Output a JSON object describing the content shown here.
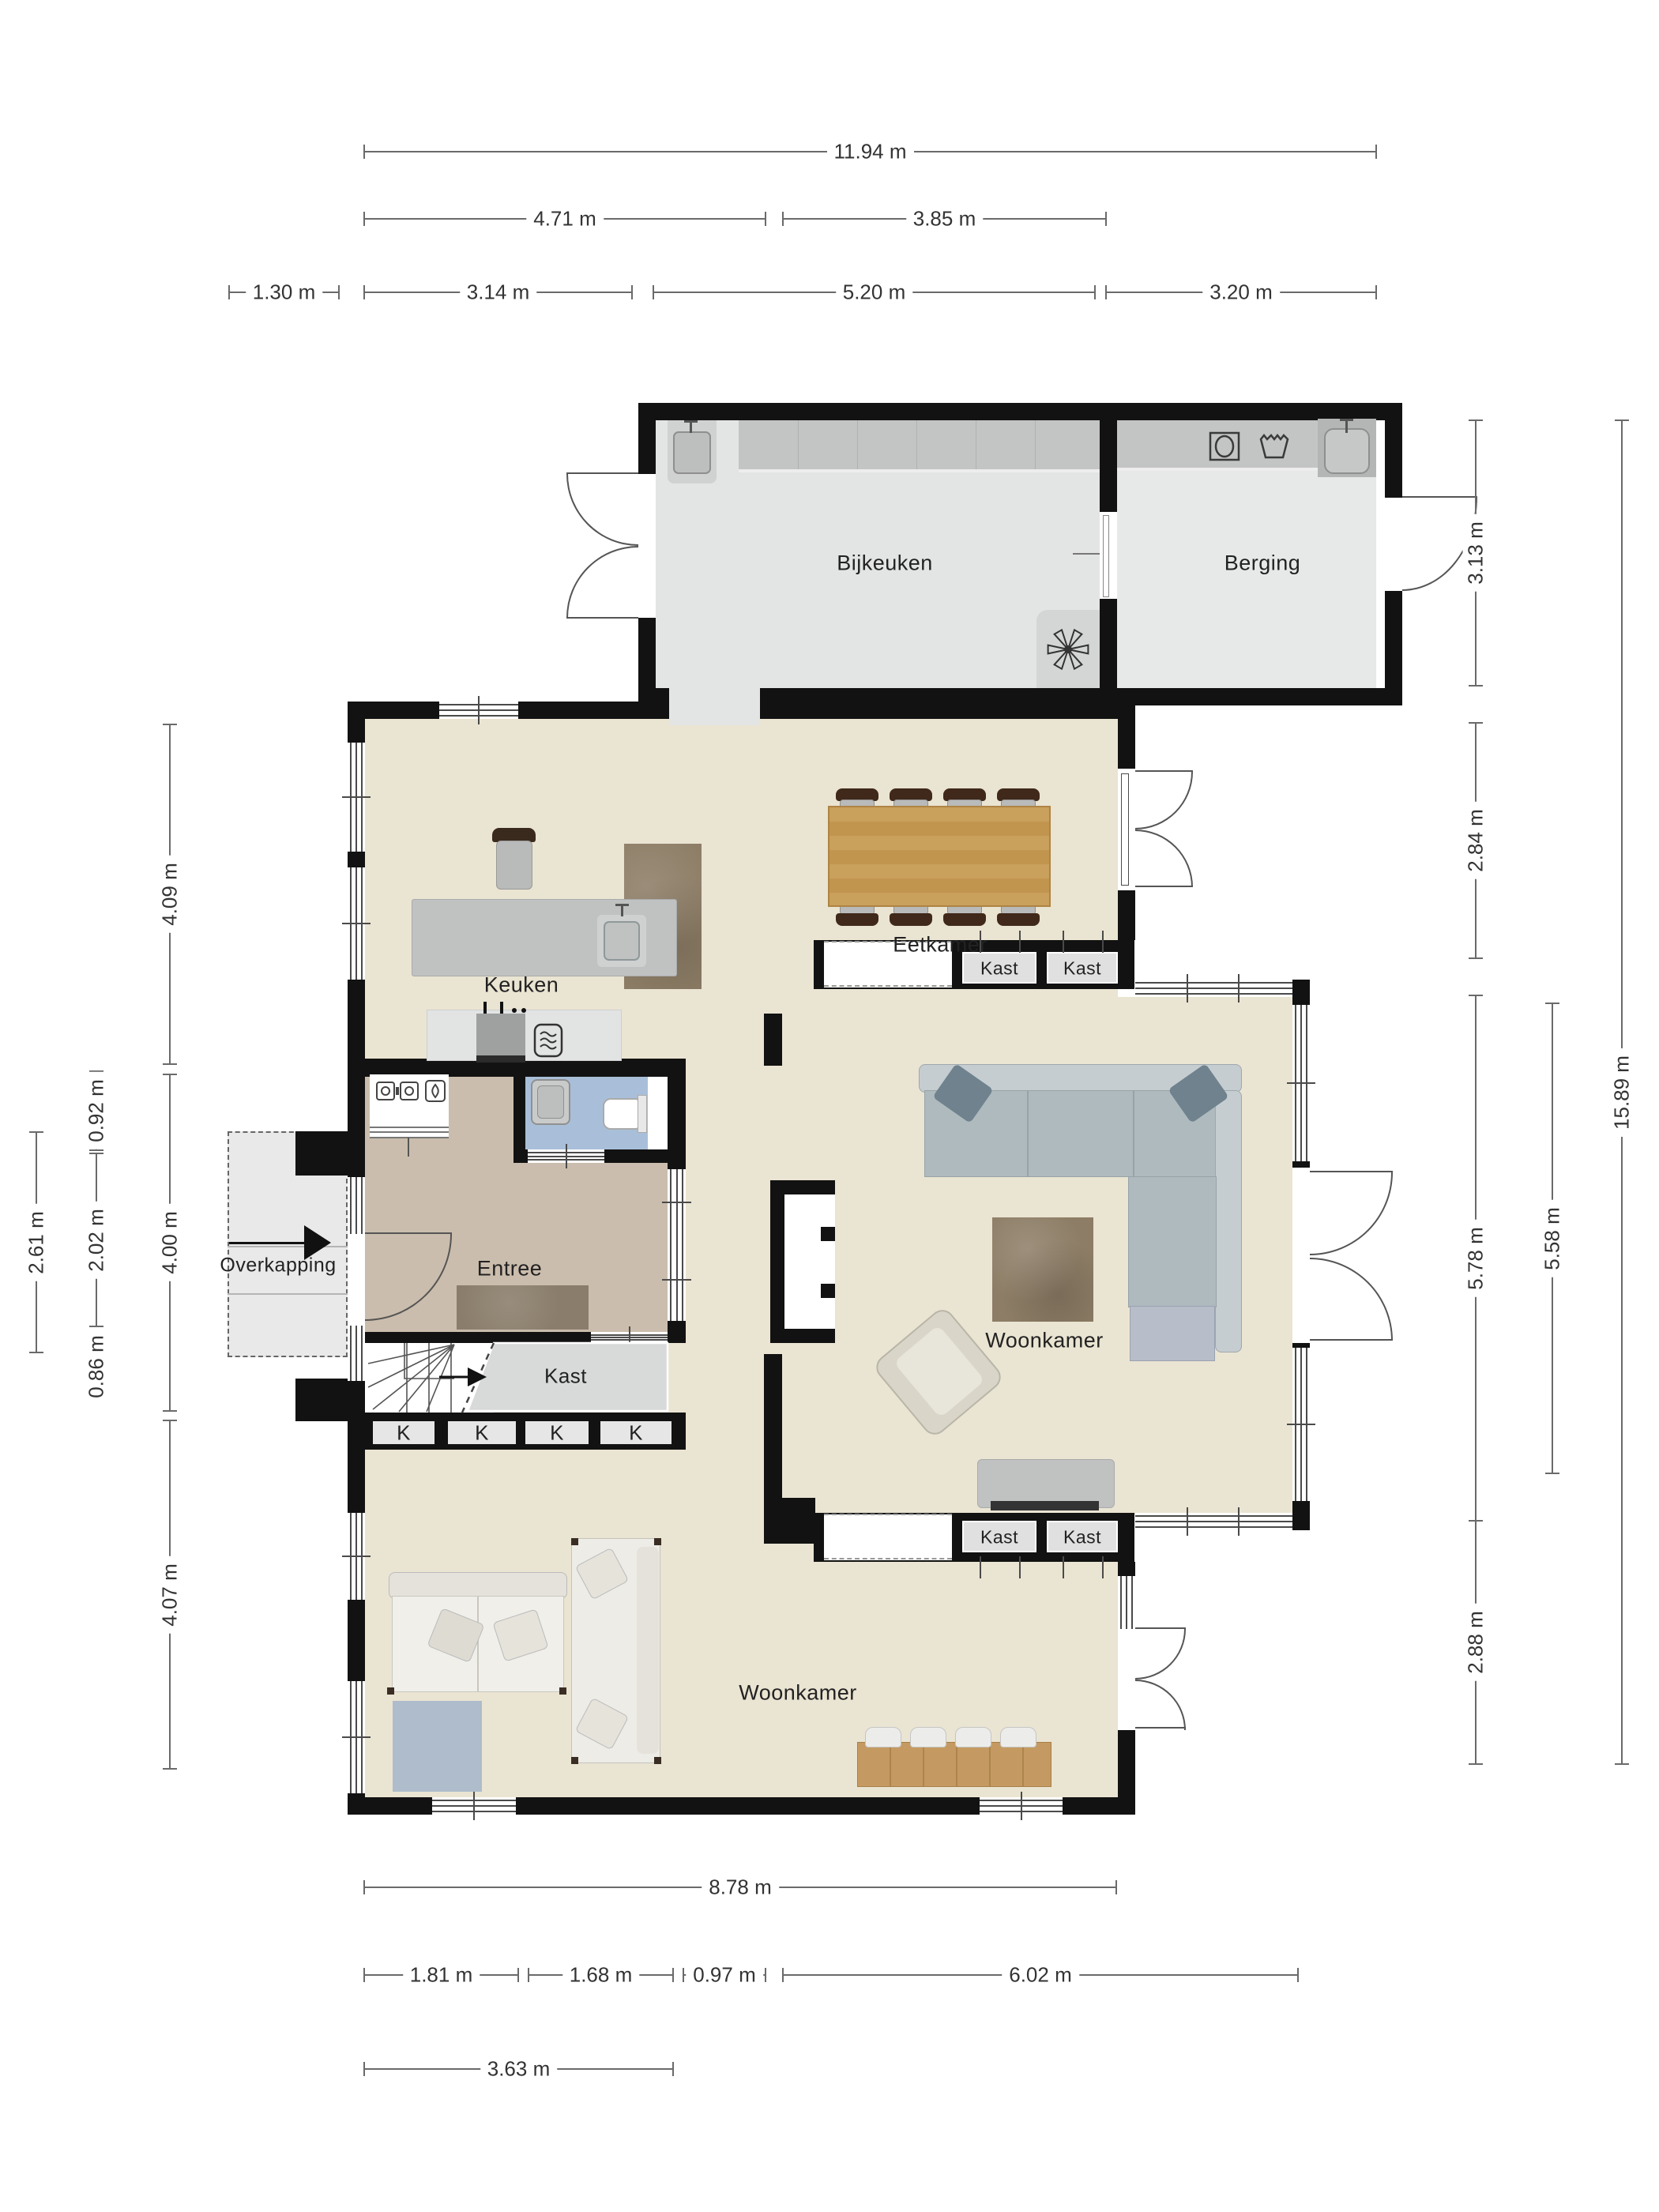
{
  "rooms": {
    "bijkeuken": "Bijkeuken",
    "berging": "Berging",
    "keuken": "Keuken",
    "eetkamer": "Eetkamer",
    "woonkamer_upper": "Woonkamer",
    "woonkamer_lower": "Woonkamer",
    "entree": "Entree",
    "overkapping": "Overkapping",
    "kast_stairs": "Kast"
  },
  "closets": {
    "kast": "Kast",
    "k": "K"
  },
  "dimensions": {
    "top": [
      {
        "value": "11.94 m"
      },
      {
        "value": "4.71 m"
      },
      {
        "value": "3.85 m"
      },
      {
        "value": "1.30 m"
      },
      {
        "value": "3.14 m"
      },
      {
        "value": "5.20 m"
      },
      {
        "value": "3.20 m"
      }
    ],
    "left": [
      {
        "value": "4.09 m"
      },
      {
        "value": "0.92 m"
      },
      {
        "value": "2.02 m"
      },
      {
        "value": "0.86 m"
      },
      {
        "value": "2.61 m"
      },
      {
        "value": "4.00 m"
      },
      {
        "value": "4.07 m"
      }
    ],
    "right": [
      {
        "value": "3.13 m"
      },
      {
        "value": "2.84 m"
      },
      {
        "value": "5.78 m"
      },
      {
        "value": "5.58 m"
      },
      {
        "value": "2.88 m"
      },
      {
        "value": "15.89 m"
      }
    ],
    "bottom": [
      {
        "value": "8.78 m"
      },
      {
        "value": "1.81 m"
      },
      {
        "value": "1.68 m"
      },
      {
        "value": "0.97 m"
      },
      {
        "value": "6.02 m"
      },
      {
        "value": "3.63 m"
      }
    ]
  },
  "icons": [
    "washing-machine-icon",
    "laundry-basket-icon",
    "sink-icon",
    "fan-icon",
    "toilet-icon",
    "electric-meter-icon",
    "gas-meter-icon",
    "oven-icon",
    "cooktop-icon",
    "stairs-direction-arrow-icon",
    "entrance-arrow-icon"
  ],
  "colors": {
    "wall": "#121212",
    "line": "#555555",
    "dim": "#6a6a6a",
    "floor_main": "#EAE4D2",
    "floor_utility": "#E3E4E4",
    "floor_utility_light": "#E7E8E8",
    "floor_entree": "#CBBDAD",
    "floor_bath": "#A9BFD9",
    "counter_dark": "#C3C4C4",
    "counter_light": "#E2E3E3",
    "island": "#C0C2C2",
    "wood": "#C9A05C",
    "wood_dark": "#AF8443",
    "bench_wood": "#C59A62",
    "rug_brown": "#8D7D66",
    "rug_taupe": "#8A7D6B",
    "rug_blue": "#AEBCCB",
    "sofa_gray": "#AFBABF",
    "sofa_gray_light": "#C5CDD1",
    "cushion_blue": "#6F828D",
    "sofa_cream": "#F0EFEA",
    "sofa_cream_dark": "#E4E2DB",
    "closet_gray": "#D8D9D9",
    "niche_gray": "#E0E0E0",
    "chair_brown": "#40291A",
    "seat_gray": "#B9BABA"
  }
}
